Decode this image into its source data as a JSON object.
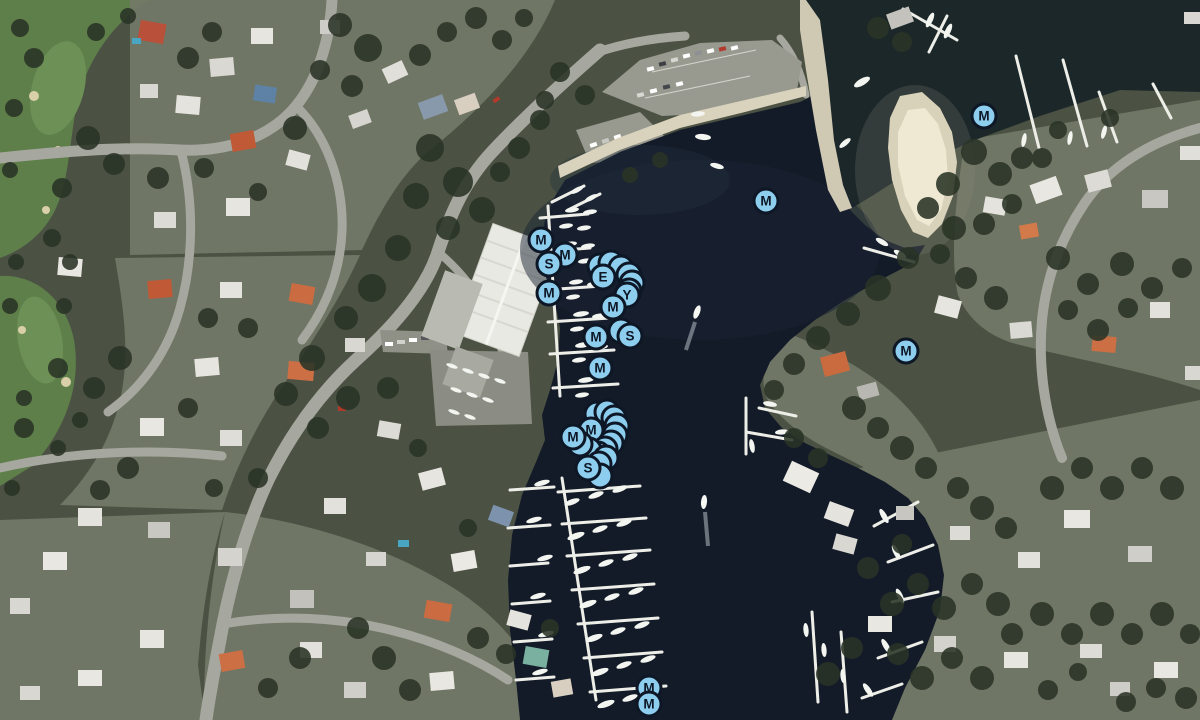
{
  "app": {
    "title": "Satellite marina map"
  },
  "map": {
    "view_mode": "satellite",
    "size": {
      "width": 1200,
      "height": 720
    },
    "marker_style": {
      "fill": "#8dcdee",
      "border": "#0d1726",
      "text": "#0d1726",
      "diameter_px": 27,
      "border_px": 3.5
    },
    "pins": [
      {
        "label": "",
        "x": 600,
        "y": 266
      },
      {
        "label": "",
        "x": 611,
        "y": 263
      },
      {
        "label": "",
        "x": 621,
        "y": 268
      },
      {
        "label": "",
        "x": 629,
        "y": 275
      },
      {
        "label": "",
        "x": 632,
        "y": 283
      },
      {
        "label": "",
        "x": 629,
        "y": 291
      },
      {
        "label": "E",
        "x": 603,
        "y": 277
      },
      {
        "label": "Y",
        "x": 627,
        "y": 295
      },
      {
        "label": "M",
        "x": 613,
        "y": 307
      },
      {
        "label": "M",
        "x": 541,
        "y": 240
      },
      {
        "label": "M",
        "x": 565,
        "y": 255
      },
      {
        "label": "S",
        "x": 549,
        "y": 264
      },
      {
        "label": "M",
        "x": 549,
        "y": 293
      },
      {
        "label": "M",
        "x": 596,
        "y": 337
      },
      {
        "label": "",
        "x": 621,
        "y": 331
      },
      {
        "label": "S",
        "x": 630,
        "y": 336
      },
      {
        "label": "M",
        "x": 600,
        "y": 368
      },
      {
        "label": "",
        "x": 597,
        "y": 414
      },
      {
        "label": "",
        "x": 607,
        "y": 412
      },
      {
        "label": "",
        "x": 614,
        "y": 418
      },
      {
        "label": "",
        "x": 617,
        "y": 426
      },
      {
        "label": "",
        "x": 615,
        "y": 435
      },
      {
        "label": "M",
        "x": 591,
        "y": 430
      },
      {
        "label": "",
        "x": 611,
        "y": 443
      },
      {
        "label": "",
        "x": 605,
        "y": 449
      },
      {
        "label": "",
        "x": 598,
        "y": 454
      },
      {
        "label": "",
        "x": 589,
        "y": 450
      },
      {
        "label": "",
        "x": 580,
        "y": 444
      },
      {
        "label": "M",
        "x": 573,
        "y": 437
      },
      {
        "label": "",
        "x": 606,
        "y": 458
      },
      {
        "label": "",
        "x": 599,
        "y": 464
      },
      {
        "label": "",
        "x": 600,
        "y": 476
      },
      {
        "label": "S",
        "x": 588,
        "y": 468
      },
      {
        "label": "M",
        "x": 766,
        "y": 201
      },
      {
        "label": "M",
        "x": 984,
        "y": 116
      },
      {
        "label": "M",
        "x": 906,
        "y": 351
      },
      {
        "label": "M",
        "x": 649,
        "y": 688
      },
      {
        "label": "M",
        "x": 649,
        "y": 704
      }
    ]
  }
}
